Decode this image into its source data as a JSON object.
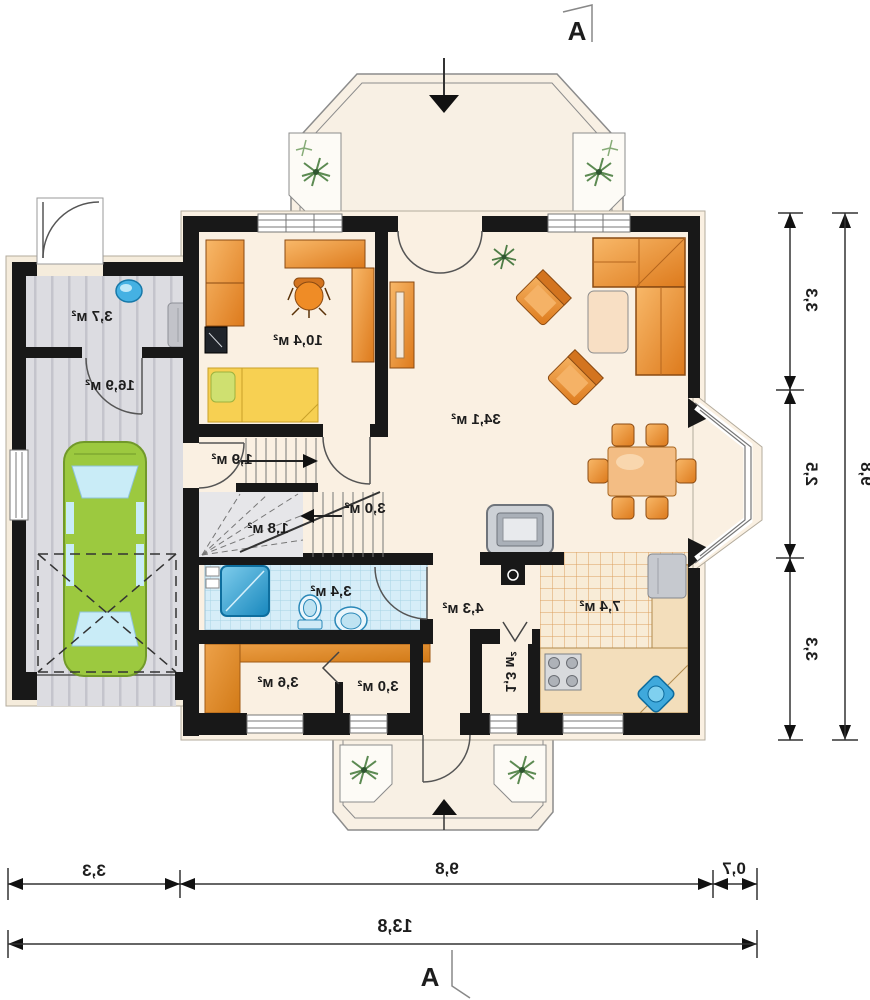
{
  "plan": {
    "section_marker_top": "A",
    "section_marker_bottom": "A",
    "room_areas": {
      "garage_storage": "3,7 м²",
      "garage": "16,9 м²",
      "office": "10,4 м²",
      "living_room": "34,1 м²",
      "entry": "1,9 м²",
      "under_stairs": "1,8 м²",
      "stairs": "3,0 м²",
      "bathroom": "3,4 м²",
      "hall": "4,3 м²",
      "kitchen": "7,4 м²",
      "closet": "3,6 м²",
      "pantry": "3,0 м²",
      "larder": "1,3 м²"
    },
    "dimensions": {
      "right_segments": [
        "3,3",
        "2,5",
        "3,3"
      ],
      "right_total": "9,8",
      "bottom_segments": [
        "3,3",
        "9,8",
        "0,7"
      ],
      "bottom_total": "13,8"
    },
    "colors": {
      "wall": "#1a1a1a",
      "floor": "#faf0e2",
      "furniture_orange": "#e8872e",
      "car_green": "#9cc93f",
      "water_blue": "#3fa9dc"
    }
  }
}
